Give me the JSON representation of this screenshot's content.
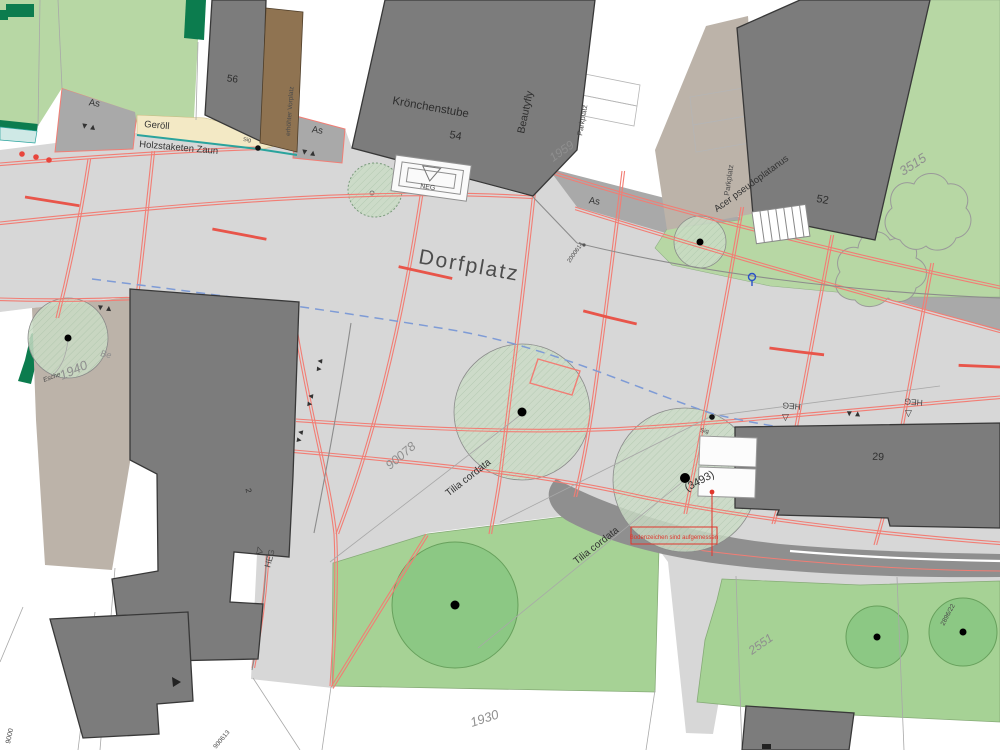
{
  "labels": {
    "dorfplatz": "Dorfplatz",
    "b56": "56",
    "geroell": "Geröll",
    "holz": "Holzstaketen Zaun",
    "sig_top": "Sig",
    "vorplatz": "erhöhter Vorplatz",
    "as_w": "As",
    "as_m": "As",
    "as_e": "As",
    "kroenchen": "Krönchenstube",
    "b54": "54",
    "beautyfly": "Beautyfly",
    "p1959": "1959",
    "parkplatz_e": "Parkplatz",
    "parkplatz_n": "Parkplatz",
    "ac": "Acer pseudoplatanus",
    "b52": "52",
    "p3515": "3515",
    "neg": "NEG",
    "heg_s": "HEG",
    "heg_m": "HEG",
    "heg_e": "HEG",
    "pt2000614": "2000614",
    "b29": "29",
    "sig": "Sig",
    "p90078": "90078",
    "tilia_w": "Tilia cordata",
    "tilia_s": "Tilia cordata",
    "t3493": "(3493)",
    "note": "Bodenzeichen sind aufgemessen",
    "esche": "Esche",
    "be": "Be",
    "p1940": "1940",
    "b2": "2",
    "p1930": "1930",
    "p2551": "2551",
    "p2896": "2896/22",
    "p900613": "900613",
    "p9000": "9000"
  },
  "icons": {
    "updown": "▼▲",
    "tri_up": "△",
    "tri_down": "▽"
  },
  "colors": {
    "paved": "#d7d7d7",
    "band": "#a9a9a9",
    "building": "#7c7c7c",
    "building_stroke": "#383838",
    "green_field": "#b7d7a4",
    "green_area": "#a6d295",
    "tree_pale": "#cadcc6",
    "tree_dark": "#8cc884",
    "hedge": "#0c7c4e",
    "fence_teal": "#2aa39d",
    "water_cyan": "#cfe9e6",
    "survey_red": "#f27d74",
    "marking_red": "#e8554a",
    "note_red": "#e0362c",
    "dash_blue": "#7e9bd6",
    "road_dark": "#8f8f8f",
    "taupe": "#bcb3a9",
    "brown": "#8f7351",
    "cream": "#f3e9c5",
    "curb": "#8c8c8c"
  }
}
